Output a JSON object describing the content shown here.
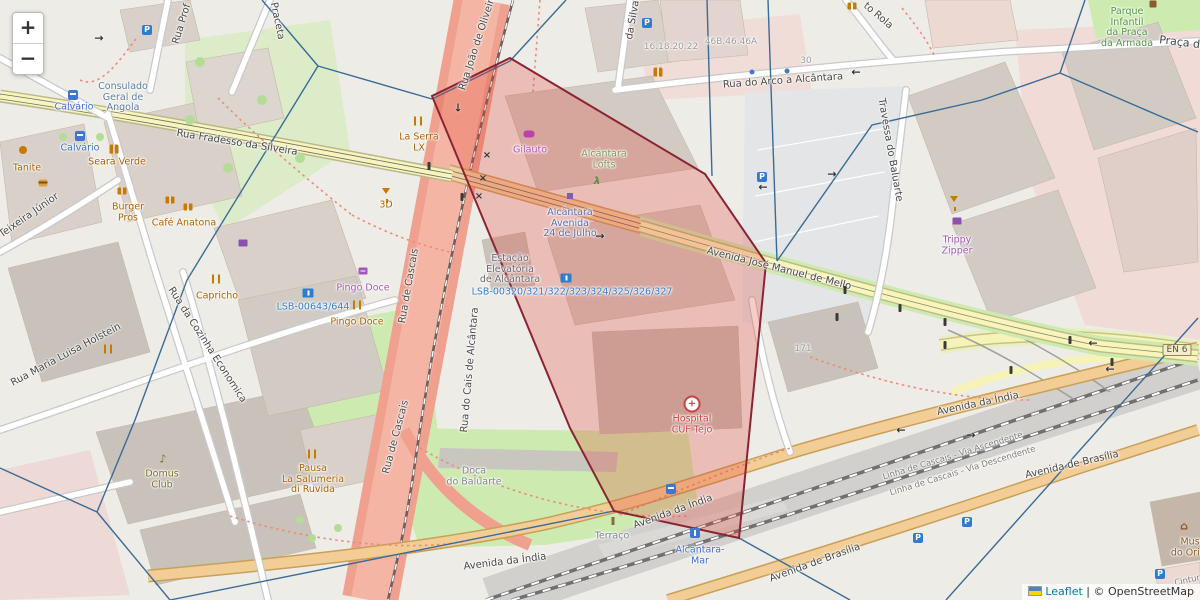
{
  "map": {
    "controls": {
      "zoom_in": "+",
      "zoom_out": "−"
    },
    "attribution": {
      "leaflet": "Leaflet",
      "separator": " | ",
      "osm": "© OpenStreetMap"
    },
    "icon_glyphs": {
      "parking": "P",
      "hosp": "+",
      "music": "♪",
      "museum": "⌂",
      "arrowL": "←",
      "arrowR": "→",
      "arrowD": "↓",
      "xmark": "×",
      "runner": "λ"
    },
    "labels": [
      {
        "n": "street-fradesso",
        "cls": "c-st",
        "x": 237,
        "y": 143,
        "rot": 9,
        "lines": [
          "Rua Fradesso da Silveira"
        ]
      },
      {
        "n": "street-mello",
        "cls": "c-st",
        "x": 779,
        "y": 269,
        "rot": 14,
        "lines": [
          "Avenida José Manuel de Mello"
        ]
      },
      {
        "n": "street-india-a",
        "cls": "c-st",
        "x": 505,
        "y": 562,
        "rot": -7,
        "lines": [
          "Avenida da Índia"
        ]
      },
      {
        "n": "street-india-b",
        "cls": "c-st",
        "x": 673,
        "y": 512,
        "rot": -20,
        "lines": [
          "Avenida da Índia"
        ]
      },
      {
        "n": "street-india-c",
        "cls": "c-st",
        "x": 978,
        "y": 404,
        "rot": -12,
        "lines": [
          "Avenida da Índia"
        ]
      },
      {
        "n": "street-brasilia-a",
        "cls": "c-st",
        "x": 1072,
        "y": 465,
        "rot": -13,
        "lines": [
          "Avenida de Brasília"
        ]
      },
      {
        "n": "street-brasilia-b",
        "cls": "c-st",
        "x": 815,
        "y": 563,
        "rot": -20,
        "lines": [
          "Avenida de Brasília"
        ]
      },
      {
        "n": "street-arco",
        "cls": "c-st",
        "x": 783,
        "y": 81,
        "rot": -4,
        "lines": [
          "Rua do Arco a Alcântara"
        ]
      },
      {
        "n": "street-praca-armada",
        "cls": "c-st",
        "x": 1206,
        "y": 46,
        "rot": 7,
        "fs": 11,
        "lines": [
          "Praça da Armada"
        ]
      },
      {
        "n": "street-rola",
        "cls": "c-st",
        "x": 878,
        "y": 16,
        "rot": 40,
        "lines": [
          "to Rola"
        ]
      },
      {
        "n": "street-rua-prof",
        "cls": "c-st",
        "x": 182,
        "y": 24,
        "rot": -73,
        "lines": [
          "Rua Prof"
        ]
      },
      {
        "n": "street-praceta",
        "cls": "c-st",
        "x": 277,
        "y": 21,
        "rot": 78,
        "lines": [
          "Praceta"
        ]
      },
      {
        "n": "street-teixeira",
        "cls": "c-st",
        "x": 20,
        "y": 222,
        "rot": -35,
        "lines": [
          "Rua Teixeira Júnior"
        ]
      },
      {
        "n": "street-holstein",
        "cls": "c-st",
        "x": 66,
        "y": 355,
        "rot": -28,
        "lines": [
          "Rua Maria Luisa Holstein"
        ]
      },
      {
        "n": "street-cozinha",
        "cls": "c-st",
        "x": 207,
        "y": 345,
        "rot": 57,
        "lines": [
          "Rua da Cozinha Economica"
        ]
      },
      {
        "n": "street-cascais-1",
        "cls": "c-st",
        "x": 409,
        "y": 286,
        "rot": -80,
        "lines": [
          "Rua de Cascais"
        ]
      },
      {
        "n": "street-cascais-2",
        "cls": "c-st",
        "x": 396,
        "y": 437,
        "rot": -75,
        "lines": [
          "Rua de Cascais"
        ]
      },
      {
        "n": "street-cais",
        "cls": "c-st",
        "x": 470,
        "y": 370,
        "rot": -85,
        "lines": [
          "Rua do Cais de Alcântara"
        ]
      },
      {
        "n": "street-joao",
        "cls": "c-st",
        "x": 478,
        "y": 42,
        "rot": -72,
        "lines": [
          "Rua João de Oliveira"
        ]
      },
      {
        "n": "street-silva",
        "cls": "c-st",
        "x": 633,
        "y": 20,
        "rot": -80,
        "lines": [
          "da Silva"
        ]
      },
      {
        "n": "street-travessa",
        "cls": "c-st",
        "x": 890,
        "y": 150,
        "rot": 80,
        "lines": [
          "Travessa do Baluarte"
        ]
      },
      {
        "n": "rail-ascendente",
        "cls": "c-rail",
        "x": 953,
        "y": 457,
        "rot": -17,
        "lines": [
          "Linha de Cascais - Via Ascendente"
        ]
      },
      {
        "n": "rail-descendente",
        "cls": "c-rail",
        "x": 963,
        "y": 472,
        "rot": -17,
        "lines": [
          "Linha de Cascais - Via Descendente"
        ]
      },
      {
        "n": "rail-cintura",
        "cls": "c-rail",
        "x": 1190,
        "y": 581,
        "rot": -12,
        "lines": [
          "Cintura"
        ]
      },
      {
        "n": "housenum-1",
        "cls": "c-num",
        "x": 671,
        "y": 47,
        "rot": 0,
        "lines": [
          "16.18.20.22"
        ]
      },
      {
        "n": "housenum-2",
        "cls": "c-num",
        "x": 731,
        "y": 42,
        "rot": 0,
        "lines": [
          "46B.46.46A"
        ]
      },
      {
        "n": "housenum-3",
        "cls": "c-num",
        "x": 806,
        "y": 61,
        "rot": 0,
        "lines": [
          "30"
        ]
      },
      {
        "n": "housenum-4",
        "cls": "c-num",
        "x": 803,
        "y": 349,
        "rot": 0,
        "lines": [
          "171"
        ]
      },
      {
        "n": "poi-calvario-1",
        "cls": "c-blu",
        "x": 74,
        "y": 108,
        "rot": 0,
        "lines": [
          "Calvário"
        ]
      },
      {
        "n": "poi-calvario-2",
        "cls": "c-blu",
        "x": 80,
        "y": 149,
        "rot": 0,
        "lines": [
          "Calvário"
        ]
      },
      {
        "n": "poi-consulado",
        "cls": "c-emb",
        "x": 123,
        "y": 98,
        "rot": 0,
        "lines": [
          "Consulado",
          "Geral de",
          "Angola"
        ]
      },
      {
        "n": "poi-tanite",
        "cls": "c-org",
        "x": 27,
        "y": 169,
        "rot": 0,
        "lines": [
          "Tanite"
        ]
      },
      {
        "n": "poi-seara-verde",
        "cls": "c-org",
        "x": 117,
        "y": 163,
        "rot": 0,
        "lines": [
          "Seara Verde"
        ]
      },
      {
        "n": "poi-burger-pros",
        "cls": "c-org",
        "x": 128,
        "y": 213,
        "rot": 0,
        "lines": [
          "Burger",
          "Pros"
        ]
      },
      {
        "n": "poi-cafe-anatona",
        "cls": "c-org",
        "x": 184,
        "y": 224,
        "rot": 0,
        "lines": [
          "Café Anatona"
        ]
      },
      {
        "n": "poi-3d",
        "cls": "c-org",
        "x": 386,
        "y": 206,
        "rot": 0,
        "lines": [
          "3D"
        ]
      },
      {
        "n": "poi-capricho",
        "cls": "c-org",
        "x": 217,
        "y": 297,
        "rot": 0,
        "lines": [
          "Capricho"
        ]
      },
      {
        "n": "poi-pingo-doce-shop",
        "cls": "c-pur",
        "x": 363,
        "y": 289,
        "rot": 0,
        "lines": [
          "Pingo Doce"
        ]
      },
      {
        "n": "poi-pingo-doce-rest",
        "cls": "c-org",
        "x": 357,
        "y": 323,
        "rot": 0,
        "lines": [
          "Pingo Doce"
        ]
      },
      {
        "n": "poi-lsb-00643",
        "cls": "c-lbl2",
        "x": 313,
        "y": 308,
        "rot": 0,
        "lines": [
          "LSB-00643/644"
        ]
      },
      {
        "n": "poi-la-serra-lx",
        "cls": "c-org",
        "x": 419,
        "y": 143,
        "rot": 0,
        "lines": [
          "La Serra",
          "LX"
        ]
      },
      {
        "n": "poi-gilauto",
        "cls": "c-mag",
        "x": 530,
        "y": 151,
        "rot": 0,
        "lines": [
          "Gilauto"
        ]
      },
      {
        "n": "poi-alcantara-lofts",
        "cls": "c-loft",
        "x": 604,
        "y": 160,
        "rot": 0,
        "lines": [
          "Alcântara",
          "Lofts"
        ]
      },
      {
        "n": "poi-station-24-julho",
        "cls": "c-ind",
        "x": 570,
        "y": 224,
        "rot": 0,
        "lines": [
          "Alcântara",
          "Avenida",
          "24 de Julho"
        ]
      },
      {
        "n": "poi-estacao-elevatoria",
        "cls": "c-mve",
        "x": 510,
        "y": 270,
        "rot": 0,
        "lines": [
          "Estação",
          "Elevatória",
          "de Alcântara"
        ]
      },
      {
        "n": "poi-lsb-00320",
        "cls": "c-lbl2",
        "x": 572,
        "y": 293,
        "rot": 0,
        "lines": [
          "LSB-00320/321/322/323/324/325/326/327"
        ]
      },
      {
        "n": "poi-hospital-cuf",
        "cls": "c-red",
        "x": 692,
        "y": 425,
        "rot": 0,
        "lines": [
          "Hospital",
          "CUF Tejo"
        ]
      },
      {
        "n": "poi-doca-baluarte",
        "cls": "c-gry",
        "x": 474,
        "y": 477,
        "rot": 0,
        "lines": [
          "Doca",
          "do Baluarte"
        ]
      },
      {
        "n": "poi-terraco",
        "cls": "c-gry",
        "x": 612,
        "y": 537,
        "rot": 0,
        "lines": [
          "Terraço"
        ]
      },
      {
        "n": "poi-alcantara-mar",
        "cls": "c-blu",
        "x": 700,
        "y": 556,
        "rot": 0,
        "lines": [
          "Alcântara-",
          "Mar"
        ]
      },
      {
        "n": "poi-domus-club",
        "cls": "c-olv",
        "x": 162,
        "y": 480,
        "rot": 0,
        "lines": [
          "Domus",
          "Club"
        ]
      },
      {
        "n": "poi-pausa-salumeria",
        "cls": "c-org",
        "x": 313,
        "y": 480,
        "rot": 0,
        "lines": [
          "Pausa",
          "La Salumeria",
          "di Ruvida"
        ]
      },
      {
        "n": "poi-trippy-zipper",
        "cls": "c-pur",
        "x": 957,
        "y": 246,
        "rot": 0,
        "lines": [
          "Trippy",
          "Zipper"
        ]
      },
      {
        "n": "poi-parque-infantil",
        "cls": "c-grn",
        "x": 1127,
        "y": 28,
        "rot": 0,
        "lines": [
          "Parque",
          "Infantil",
          "da Praça",
          "da Armada"
        ]
      },
      {
        "n": "poi-museu-oriente",
        "cls": "c-brn",
        "x": 1196,
        "y": 548,
        "rot": 0,
        "lines": [
          "Museu",
          "do Oriente"
        ]
      },
      {
        "n": "road-ref-en6",
        "cls": "c-badge",
        "x": 1177,
        "y": 350,
        "rot": 0,
        "lines": [
          "EN 6"
        ]
      }
    ],
    "icons": [
      {
        "t": "bus",
        "x": 73,
        "y": 95
      },
      {
        "t": "bus",
        "x": 80,
        "y": 136
      },
      {
        "t": "bus",
        "x": 671,
        "y": 489
      },
      {
        "t": "train",
        "x": 695,
        "y": 533
      },
      {
        "t": "stsq",
        "x": 570,
        "y": 196
      },
      {
        "t": "parking",
        "x": 147,
        "y": 30
      },
      {
        "t": "parking",
        "x": 647,
        "y": 23
      },
      {
        "t": "parking",
        "x": 762,
        "y": 177
      },
      {
        "t": "parking",
        "x": 918,
        "y": 538
      },
      {
        "t": "parking",
        "x": 967,
        "y": 522
      },
      {
        "t": "parking",
        "x": 1160,
        "y": 574
      },
      {
        "t": "hosp",
        "x": 692,
        "y": 404
      },
      {
        "t": "cocktail",
        "x": 386,
        "y": 191
      },
      {
        "t": "cocktail",
        "x": 954,
        "y": 199
      },
      {
        "t": "mug2",
        "x": 122,
        "y": 191
      },
      {
        "t": "mug2",
        "x": 170,
        "y": 200
      },
      {
        "t": "mug2",
        "x": 188,
        "y": 207
      },
      {
        "t": "mug2",
        "x": 852,
        "y": 6
      },
      {
        "t": "rest",
        "x": 216,
        "y": 279
      },
      {
        "t": "rest",
        "x": 357,
        "y": 305
      },
      {
        "t": "rest",
        "x": 108,
        "y": 349
      },
      {
        "t": "rest",
        "x": 312,
        "y": 454
      },
      {
        "t": "rest",
        "x": 418,
        "y": 121
      },
      {
        "t": "people",
        "x": 114,
        "y": 149
      },
      {
        "t": "people",
        "x": 658,
        "y": 72
      },
      {
        "t": "cart",
        "x": 363,
        "y": 271
      },
      {
        "t": "shirt",
        "x": 957,
        "y": 221
      },
      {
        "t": "shirt",
        "x": 243,
        "y": 243
      },
      {
        "t": "car",
        "x": 529,
        "y": 134
      },
      {
        "t": "music",
        "x": 163,
        "y": 459
      },
      {
        "t": "fuel",
        "x": 308,
        "y": 293
      },
      {
        "t": "fuel",
        "x": 566,
        "y": 278
      },
      {
        "t": "cup",
        "x": 23,
        "y": 150
      },
      {
        "t": "museum",
        "x": 1184,
        "y": 526
      },
      {
        "t": "monu",
        "x": 613,
        "y": 521
      },
      {
        "t": "play",
        "x": 1153,
        "y": 4
      },
      {
        "t": "runner",
        "x": 597,
        "y": 182
      },
      {
        "t": "tlight",
        "x": 429,
        "y": 166
      },
      {
        "t": "tlight",
        "x": 462,
        "y": 197
      },
      {
        "t": "tlight",
        "x": 845,
        "y": 290
      },
      {
        "t": "tlight",
        "x": 900,
        "y": 308
      },
      {
        "t": "tlight",
        "x": 837,
        "y": 317
      },
      {
        "t": "tlight",
        "x": 945,
        "y": 322
      },
      {
        "t": "tlight",
        "x": 945,
        "y": 345
      },
      {
        "t": "tlight",
        "x": 1011,
        "y": 370
      },
      {
        "t": "tlight",
        "x": 1070,
        "y": 340
      },
      {
        "t": "tlight",
        "x": 1112,
        "y": 362
      },
      {
        "t": "burgerI",
        "x": 43,
        "y": 183
      },
      {
        "t": "arrowL",
        "x": 856,
        "y": 72
      },
      {
        "t": "arrowL",
        "x": 763,
        "y": 187
      },
      {
        "t": "arrowL",
        "x": 1093,
        "y": 343
      },
      {
        "t": "arrowL",
        "x": 1110,
        "y": 369
      },
      {
        "t": "arrowL",
        "x": 901,
        "y": 430
      },
      {
        "t": "arrowR",
        "x": 99,
        "y": 38
      },
      {
        "t": "arrowR",
        "x": 600,
        "y": 236
      },
      {
        "t": "arrowR",
        "x": 832,
        "y": 174
      },
      {
        "t": "arrowR",
        "x": 971,
        "y": 435
      },
      {
        "t": "arrowD",
        "x": 458,
        "y": 108
      },
      {
        "t": "xmark",
        "x": 487,
        "y": 156
      },
      {
        "t": "xmark",
        "x": 483,
        "y": 179
      },
      {
        "t": "xmark",
        "x": 479,
        "y": 197
      },
      {
        "t": "dotb",
        "x": 752,
        "y": 72
      },
      {
        "t": "dotb",
        "x": 787,
        "y": 71
      }
    ]
  },
  "overlay": {
    "polygon": {
      "points": "510,58 705,174 766,263 739,538 614,511 570,428 432,96",
      "fill": "#e34234",
      "fill_opacity": "0.27",
      "stroke": "#8a2433",
      "stroke_width": "2"
    },
    "network": {
      "path": "M262,0 L318,66 M318,66 L432,99 M432,99 L510,61 M510,61 L566,0 M318,66 L187,280 L135,420 L97,512 M97,512 L0,468 M97,512 L170,600 M170,600 L614,511 M739,538 L850,600 M707,0 L712,176 M768,0 L777,261 M777,261 L872,125 L982,100 L1060,73 M1060,73 L1162,117 L1198,132 M1060,73 L1085,0 M1198,318 L946,600",
      "color": "#3a6b96",
      "width": "1.4"
    }
  }
}
